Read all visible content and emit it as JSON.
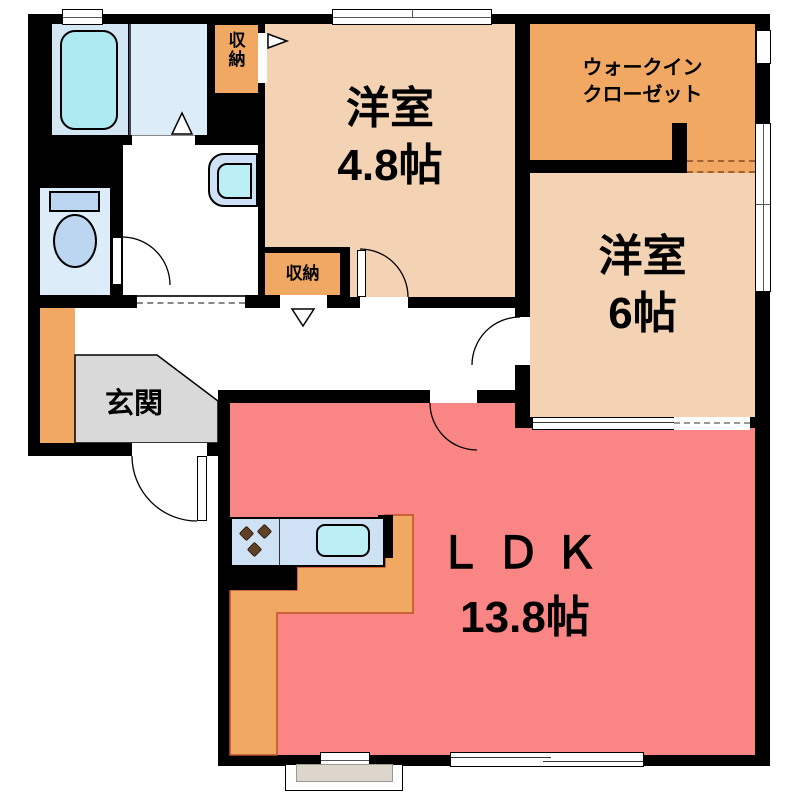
{
  "plan": {
    "type": "apartment-floor-plan",
    "rooms": {
      "y48": {
        "name": "洋室",
        "size": "4.8帖"
      },
      "y6": {
        "name": "洋室",
        "size": "6帖"
      },
      "ldk": {
        "name": "ＬＤＫ",
        "size": "13.8帖"
      },
      "wic": {
        "name_line1": "ウォークイン",
        "name_line2": "クローゼット"
      },
      "genkan": {
        "name": "玄関"
      },
      "storage_top": {
        "name": "収納"
      },
      "storage_hall": {
        "name": "収納"
      }
    },
    "colors": {
      "wall": "#000000",
      "western_room": "#f4d3b4",
      "closet_orange": "#f0a863",
      "ldk_pink": "#f98585",
      "bath_blue": "#d2e6f3",
      "washroom_blue": "#dcecf8",
      "fixture_blue": "#bcd6f2",
      "bathtub_cyan": "#aeeaf2",
      "entrance_gray": "#d9d9d9",
      "kitchen_counter_blue": "#cfe1f5",
      "sink_cyan": "#bceef6",
      "burner_brown": "#5f4226",
      "step_beige": "#ddd6cc"
    }
  }
}
